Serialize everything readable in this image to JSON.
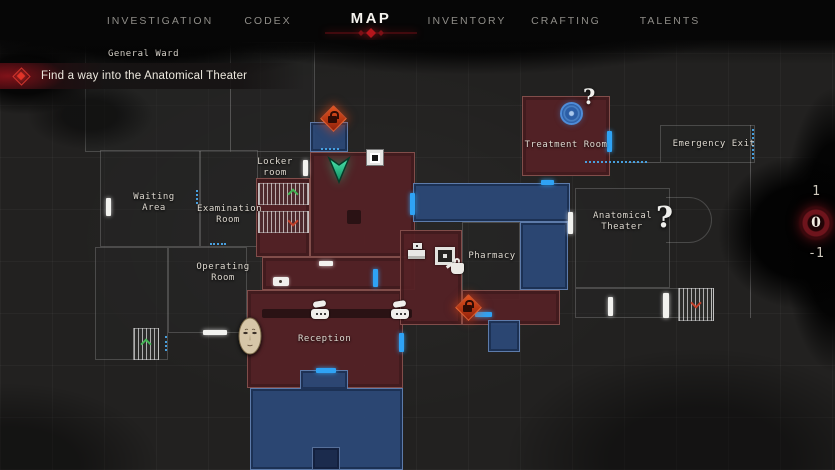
{
  "nav": {
    "tabs": [
      {
        "label": "INVESTIGATION",
        "active": false
      },
      {
        "label": "CODEX",
        "active": false
      },
      {
        "label": "MAP",
        "active": true
      },
      {
        "label": "INVENTORY",
        "active": false
      },
      {
        "label": "CRAFTING",
        "active": false
      },
      {
        "label": "TALENTS",
        "active": false
      }
    ]
  },
  "quest": {
    "objective": "Find a way into the Anatomical Theater"
  },
  "map": {
    "area_label": "General Ward",
    "rooms": [
      {
        "id": "locker-room",
        "label": "Locker room",
        "state": "explored"
      },
      {
        "id": "waiting-area",
        "label": "Waiting Area",
        "state": "unexplored"
      },
      {
        "id": "examination-room",
        "label": "Examination Room",
        "state": "unexplored"
      },
      {
        "id": "operating-room",
        "label": "Operating Room",
        "state": "unexplored"
      },
      {
        "id": "reception",
        "label": "Reception",
        "state": "explored"
      },
      {
        "id": "pharmacy",
        "label": "Pharmacy",
        "state": "unexplored"
      },
      {
        "id": "treatment-room",
        "label": "Treatment Room",
        "state": "explored"
      },
      {
        "id": "anatomical-theater",
        "label": "Anatomical Theater",
        "state": "unexplored"
      },
      {
        "id": "emergency-exit",
        "label": "Emergency Exit",
        "state": "unexplored"
      }
    ],
    "markers": {
      "treatment_unknown": "?",
      "anatomical_unknown": "?"
    },
    "icons": [
      "locked-door",
      "player-position",
      "stairs-up",
      "stairs-down",
      "door-white",
      "door-blue",
      "door-unexplored-dotted",
      "telephone-save",
      "storage-box",
      "register",
      "kettle",
      "face-mask",
      "blue-seal",
      "picture-frame"
    ]
  },
  "floor_selector": {
    "floors": [
      "1",
      "0",
      "-1"
    ],
    "current": "0"
  },
  "colors": {
    "explored_room": "#542125",
    "other_floor_room": "#2c4876",
    "accent_red": "#b5161c",
    "door_blue": "#2fa3f5",
    "player_green": "#2fd79c",
    "lock_orange": "#d2481a"
  }
}
